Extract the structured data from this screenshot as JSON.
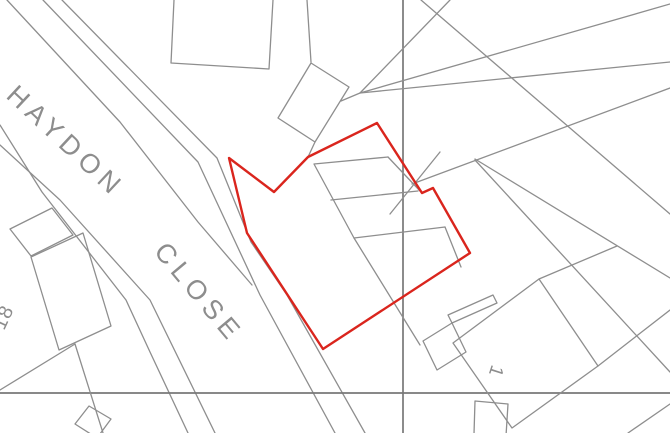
{
  "map": {
    "type": "site-location-plan",
    "labels": {
      "road_line1": "HAYDON",
      "road_line2": "CLOSE",
      "house_number_18": "18",
      "house_number_1": "1"
    },
    "colors": {
      "boundary_red": "#da251d",
      "line_gray": "#8e8e8e",
      "grid_gray": "#787878",
      "label_gray": "#8d8d8d",
      "background": "#ffffff"
    }
  }
}
